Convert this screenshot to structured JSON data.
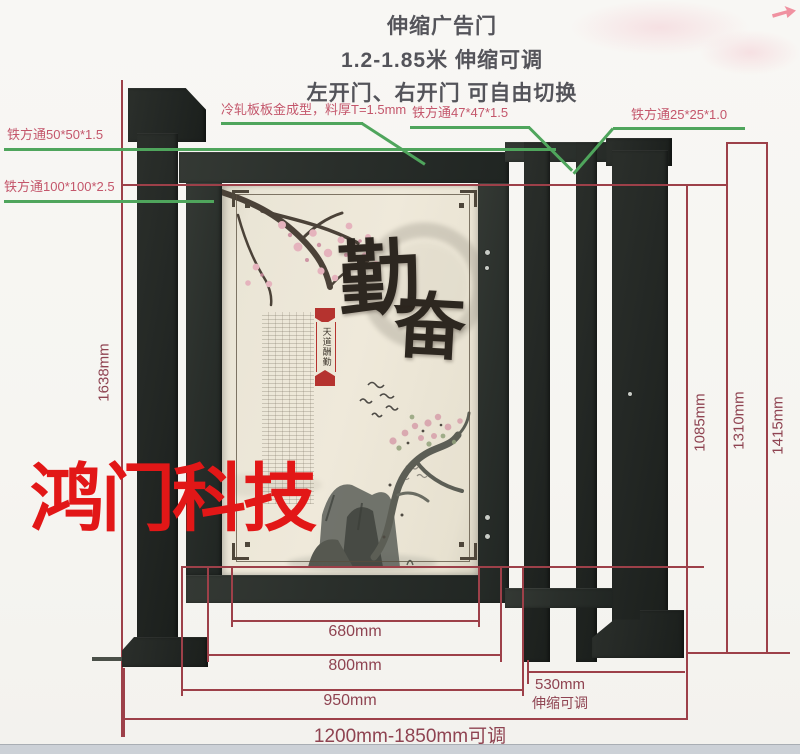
{
  "header": {
    "line1": "伸缩广告门",
    "line2": "1.2-1.85米 伸缩可调",
    "line3": "左开门、右开门 可自由切换"
  },
  "callouts": {
    "steel_50": "铁方通50*50*1.5",
    "steel_100": "铁方通100*100*2.5",
    "cold_rolled": "冷轧板板金成型，料厚T=1.5mm",
    "steel_47": "铁方通47*47*1.5",
    "steel_25": "铁方通25*25*1.0"
  },
  "dimensions": {
    "height_total": "1638mm",
    "height_inner": "1085mm",
    "height_mid": "1310mm",
    "height_outer": "1415mm",
    "width_panel": "680mm",
    "width_door": "800mm",
    "width_frame": "950mm",
    "width_range": "1200mm-1850mm可调",
    "width_telescopic": "530mm",
    "width_telescopic_note": "伸缩可调"
  },
  "panel": {
    "char_top": "勤",
    "char_bottom": "奋",
    "seal_text": "天道酬勤"
  },
  "watermark": "鸿门科技",
  "colors": {
    "dimension_red": "#9d4049",
    "label_pink": "#c4566b",
    "leader_green": "#4fa55c",
    "watermark_red": "#e21717",
    "steel_dark": "#2a2f2c",
    "panel_cream": "#eae5d6"
  }
}
